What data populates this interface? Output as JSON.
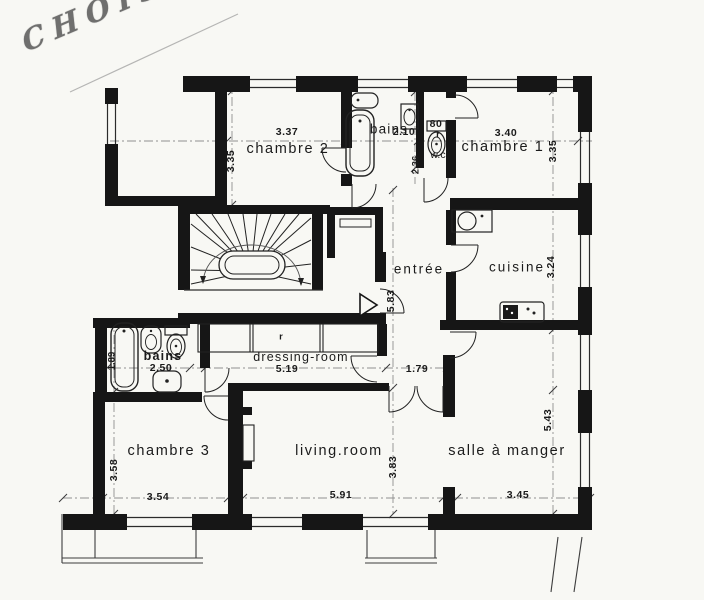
{
  "meta": {
    "stamp": "CHOISY"
  },
  "rooms": {
    "chambre2": {
      "name": "chambre 2"
    },
    "chambre1": {
      "name": "chambre 1"
    },
    "bains_top": {
      "name": "bains"
    },
    "wc": {
      "name": "w.c"
    },
    "entree": {
      "name": "entrée"
    },
    "cuisine": {
      "name": "cuisine"
    },
    "bains2": {
      "name": "bains"
    },
    "dressing": {
      "name": "dressing-room"
    },
    "chambre3": {
      "name": "chambre 3"
    },
    "living": {
      "name": "living.room"
    },
    "salle": {
      "name": "salle à manger"
    }
  },
  "dimensions": {
    "chambre2_w": "3.37",
    "bains_top_w": "2.10",
    "wc_w": "80",
    "wc_r": "r",
    "chambre1_w": "3.40",
    "chambre2_h": "3.35",
    "chambre1_h": "3.35",
    "bains_top_h": "2.36",
    "cuisine_h": "3.24",
    "entree_h": "5.83",
    "bains2_w": "2.50",
    "bains2_h": "1.89",
    "dressing_w": "5.19",
    "hall_w": "1.79",
    "chambre3_w": "3.54",
    "chambre3_h": "3.58",
    "living_w": "5.91",
    "living_h": "3.83",
    "salle_w": "3.45",
    "salle_h": "5.43"
  },
  "annotations": {
    "closet_r": "r"
  }
}
